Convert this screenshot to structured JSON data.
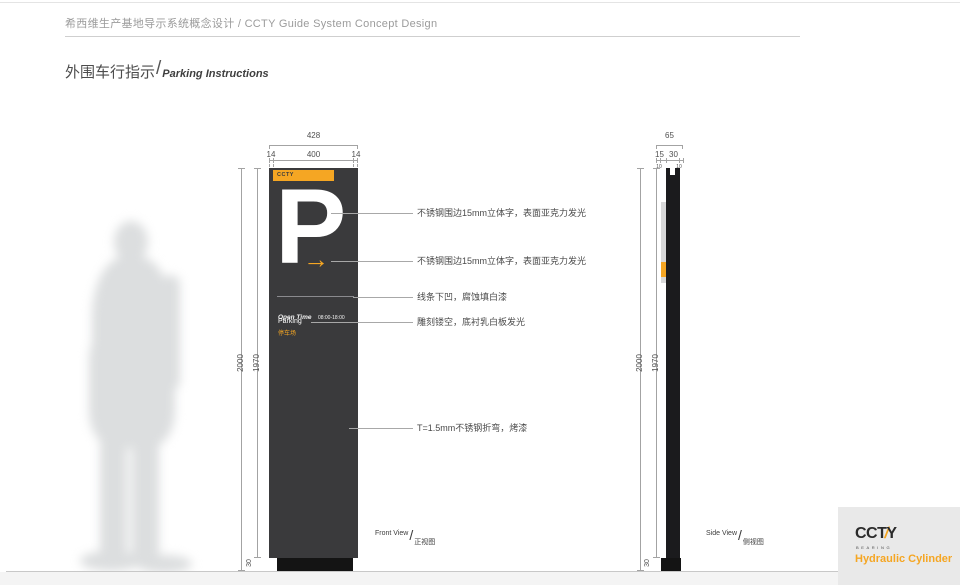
{
  "header": {
    "title": "希西维生产基地导示系统概念设计 / CCTY Guide System Concept Design"
  },
  "title": {
    "zh": "外围车行指示",
    "slash": "/",
    "en": "Parking Instructions"
  },
  "front_view": {
    "label_en": "Front View",
    "slash": "/",
    "label_zh": "正视图",
    "dims": {
      "total_width": "428",
      "side_margin_left": "14",
      "inner_width": "400",
      "side_margin_right": "14",
      "total_height": "2000",
      "panel_height": "1970",
      "base_height": "30"
    }
  },
  "side_view": {
    "label_en": "Side View",
    "slash": "/",
    "label_zh": "侧视图",
    "dims": {
      "total_depth": "65",
      "front_depth": "15",
      "back_depth": "30",
      "sub_front": "10",
      "sub_back": "10",
      "total_height": "2000",
      "panel_height": "1970",
      "base_height": "30"
    }
  },
  "sign": {
    "brand": "CCTY",
    "parking_letter": "P",
    "arrow": "→",
    "open_time_label": "Open Time",
    "open_time_value": "08:00-18:00",
    "name_en": "Parking",
    "name_zh": "停车场"
  },
  "annotations": [
    "不锈钢围边15mm立体字，表面亚克力发光",
    "不锈钢围边15mm立体字，表面亚克力发光",
    "线条下凹，腐蚀填白漆",
    "雕刻镂空，底衬乳白板发光",
    "T=1.5mm不锈钢折弯，烤漆"
  ],
  "logo": {
    "cct": "CCT",
    "slash": "/",
    "y": "Y",
    "bearing": "BEARING",
    "tagline": "Hydraulic Cylinder"
  },
  "colors": {
    "accent": "#F5A623",
    "panel_dark": "#3A3A3C",
    "ink": "#1B1B1D"
  }
}
